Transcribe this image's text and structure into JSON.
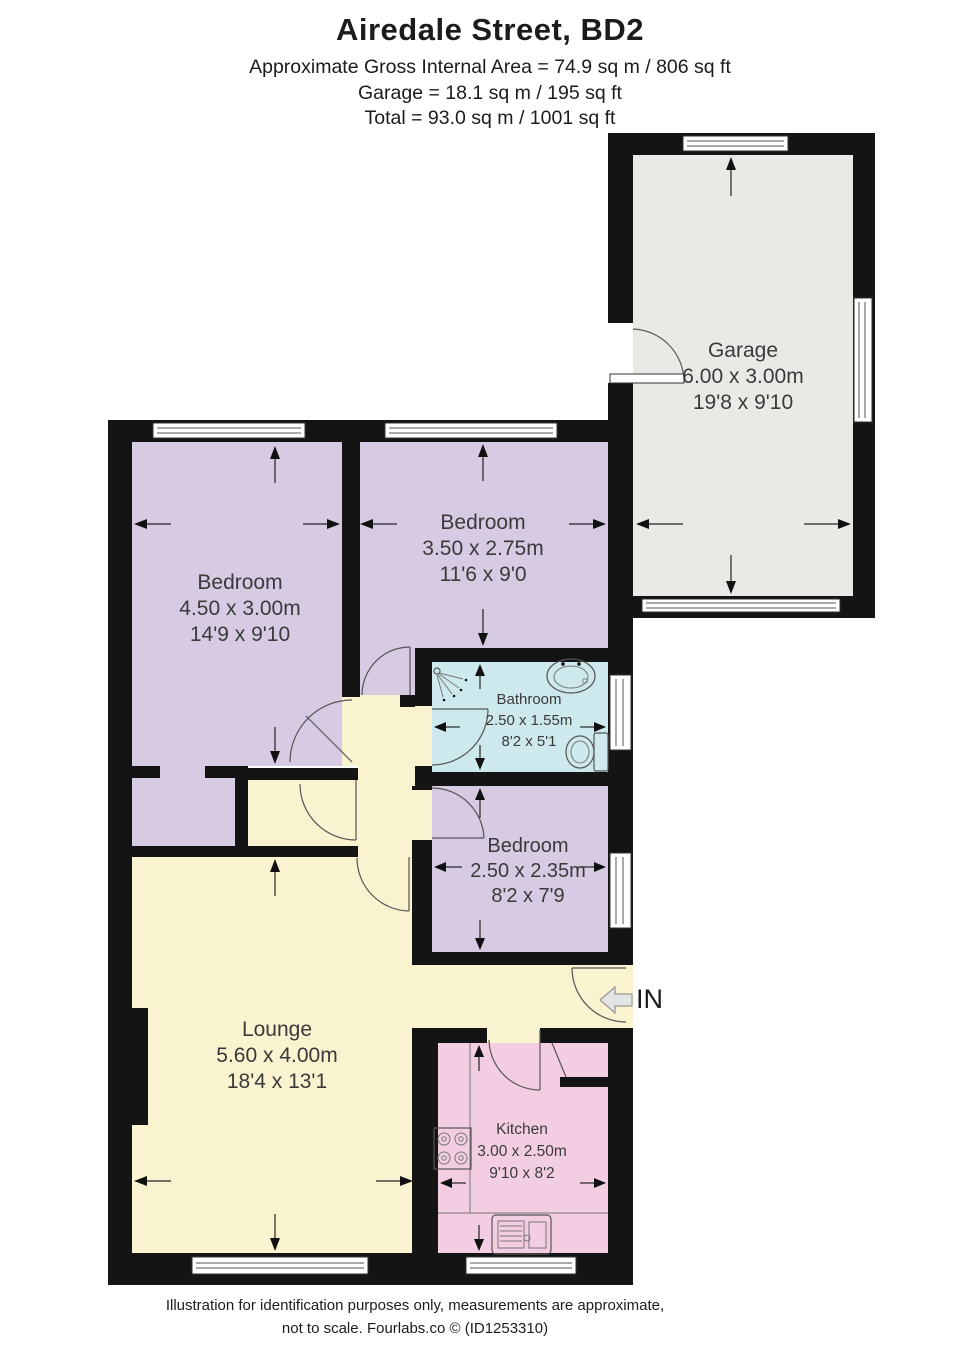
{
  "header": {
    "title": "Airedale Street, BD2",
    "line1": "Approximate Gross Internal Area = 74.9 sq m / 806 sq ft",
    "line2": "Garage = 18.1 sq m / 195 sq ft",
    "line3": "Total = 93.0 sq m / 1001 sq ft"
  },
  "rooms": {
    "garage": {
      "name": "Garage",
      "metric": "6.00 x 3.00m",
      "imperial": "19'8 x 9'10"
    },
    "bedroom1": {
      "name": "Bedroom",
      "metric": "4.50 x 3.00m",
      "imperial": "14'9 x 9'10"
    },
    "bedroom2": {
      "name": "Bedroom",
      "metric": "3.50 x 2.75m",
      "imperial": "11'6 x 9'0"
    },
    "bathroom": {
      "name": "Bathroom",
      "metric": "2.50 x 1.55m",
      "imperial": "8'2 x 5'1"
    },
    "bedroom3": {
      "name": "Bedroom",
      "metric": "2.50 x 2.35m",
      "imperial": "8'2 x 7'9"
    },
    "lounge": {
      "name": "Lounge",
      "metric": "5.60 x 4.00m",
      "imperial": "18'4 x 13'1"
    },
    "kitchen": {
      "name": "Kitchen",
      "metric": "3.00 x 2.50m",
      "imperial": "9'10 x 8'2"
    }
  },
  "entrance": {
    "label": "IN"
  },
  "footer": {
    "line1": "Illustration for identification purposes only, measurements are approximate,",
    "line2": "not to scale. Fourlabs.co © (ID1253310)"
  },
  "colors": {
    "wall": "#141414",
    "lavender": "#d7cbe4",
    "yellow": "#faf3cf",
    "blue": "#cde9ee",
    "pink": "#f3cee2",
    "gray": "#e9e9e6"
  }
}
